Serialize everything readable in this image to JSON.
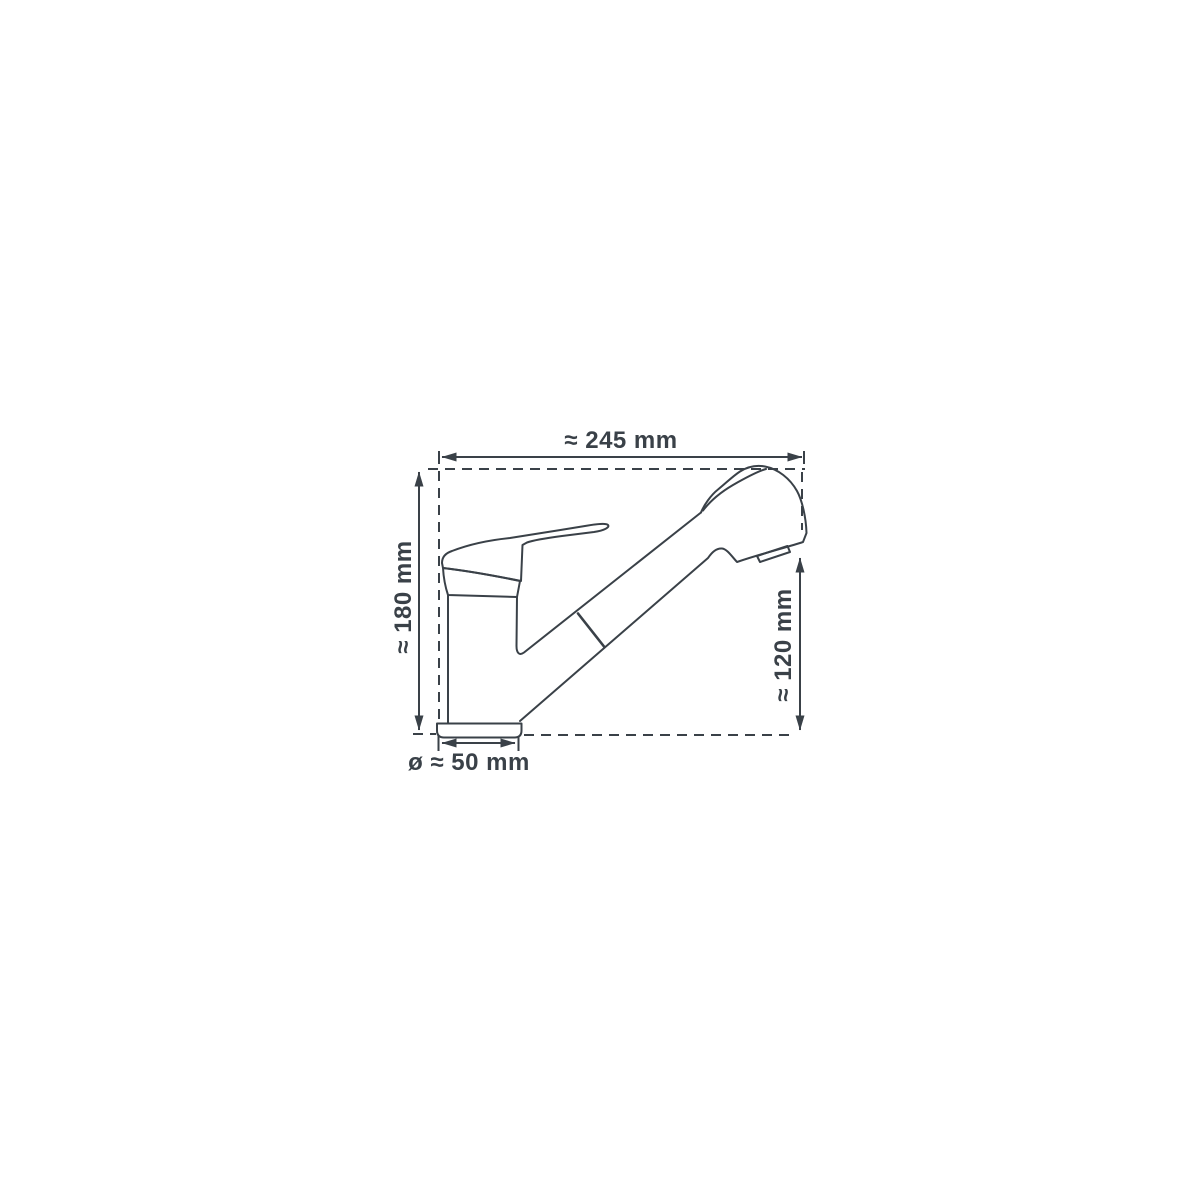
{
  "diagram": {
    "subject": "single-lever kitchen mixer tap with pull-out spray head, side view technical drawing",
    "style": "technical line drawing with dashed bounding box and dimension arrows",
    "line_color": "#3a4148",
    "background_color": "#ffffff",
    "labels": {
      "overall_width": "≈ 245 mm",
      "overall_height": "≈ 180 mm",
      "spray_head_height": "≈ 120 mm",
      "base_diameter": "ø ≈ 50 mm"
    },
    "values": {
      "overall_width_mm": 245,
      "overall_height_mm": 180,
      "spray_head_height_mm": 120,
      "base_diameter_mm": 50,
      "unit": "mm",
      "approximate": true
    }
  }
}
